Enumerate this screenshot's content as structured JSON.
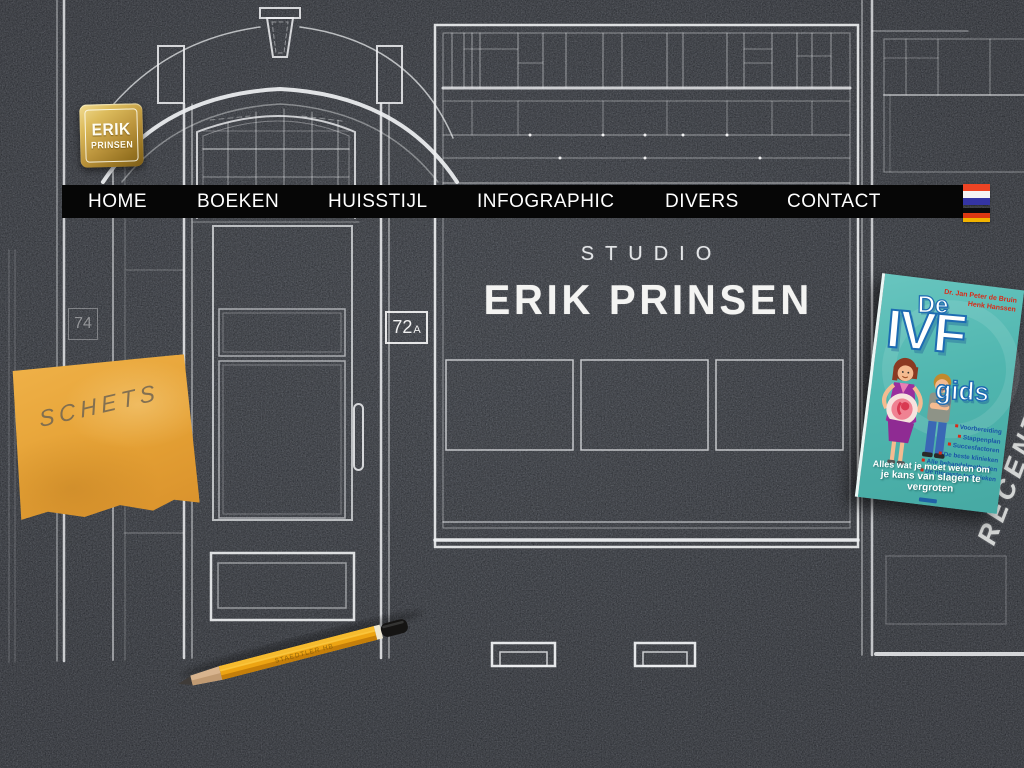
{
  "logo": {
    "line1": "ERIK",
    "line2": "PRINSEN"
  },
  "nav": {
    "items": [
      {
        "label": "HOME"
      },
      {
        "label": "BOEKEN"
      },
      {
        "label": "HUISSTIJL"
      },
      {
        "label": "INFOGRAPHIC"
      },
      {
        "label": "DIVERS"
      },
      {
        "label": "CONTACT"
      }
    ]
  },
  "flags": {
    "dutch": "dutch-flag",
    "german": "german-flag"
  },
  "hero": {
    "subtitle": "STUDIO",
    "title": "ERIK PRINSEN"
  },
  "house_numbers": {
    "left": "74",
    "right_main": "72",
    "right_suffix": "A"
  },
  "sticky_note": {
    "text": "SCHETS"
  },
  "pencil": {
    "brand": "STAEDTLER HB"
  },
  "chalk_label": {
    "text": "RECENT"
  },
  "book": {
    "title_de": "De",
    "title_ivf": "IVF",
    "title_gids": "gids",
    "authors": [
      "Dr. Jan Peter de Bruin",
      "Henk Hanssen"
    ],
    "bullets": [
      "Voorbereiding",
      "Stappenplan",
      "Succesfactoren",
      "De beste klinieken",
      "Alle behandelmethoden",
      "De nieuwste technieken"
    ],
    "tagline_line1": "Alles wat je moet weten om",
    "tagline_line2": "je kans van slagen te vergroten"
  },
  "colors": {
    "background": "#3f434c",
    "chalk_line": "#edeff1",
    "nav_bg": "#060606",
    "logo_gold": "#c9a84c",
    "sticky_note": "#e5a135",
    "book_teal": "#50b6af",
    "book_blue": "#1e6cb2",
    "book_red": "#d92a18",
    "pencil_yellow": "#eda412"
  }
}
